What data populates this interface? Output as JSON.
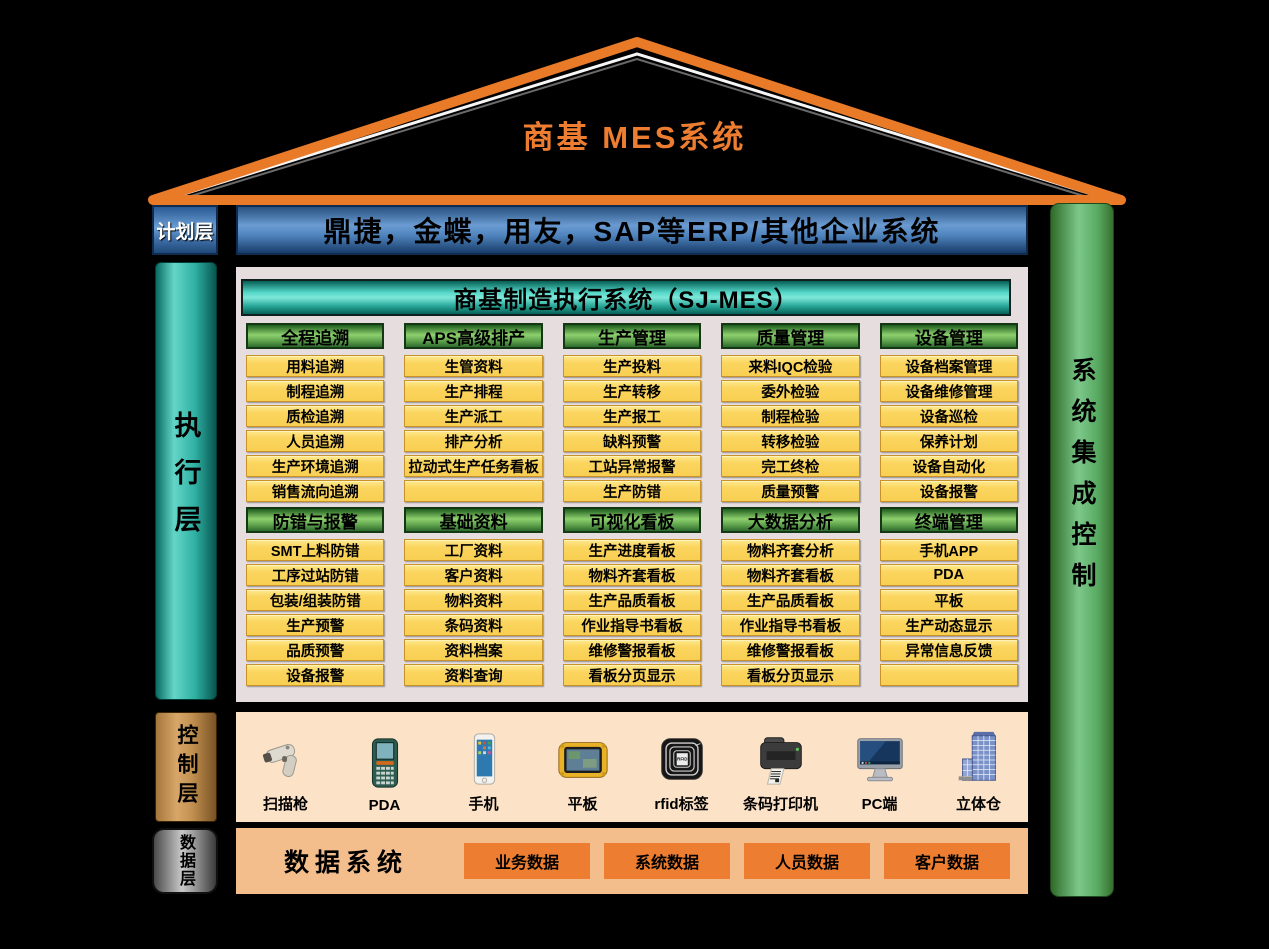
{
  "roof": {
    "title": "商基  MES系统"
  },
  "planning": {
    "label": "计划层",
    "banner": "鼎捷，金蝶，用友，SAP等ERP/其他企业系统"
  },
  "execution": {
    "label": "执行层",
    "header": "商基制造执行系统（SJ-MES）",
    "rows": [
      [
        {
          "title": "全程追溯",
          "items": [
            "用料追溯",
            "制程追溯",
            "质检追溯",
            "人员追溯",
            "生产环境追溯",
            "销售流向追溯"
          ]
        },
        {
          "title": "APS高级排产",
          "items": [
            "生管资料",
            "生产排程",
            "生产派工",
            "排产分析",
            "拉动式生产任务看板",
            ""
          ]
        },
        {
          "title": "生产管理",
          "items": [
            "生产投料",
            "生产转移",
            "生产报工",
            "缺料预警",
            "工站异常报警",
            "生产防错"
          ]
        },
        {
          "title": "质量管理",
          "items": [
            "来料IQC检验",
            "委外检验",
            "制程检验",
            "转移检验",
            "完工终检",
            "质量预警"
          ]
        },
        {
          "title": "设备管理",
          "items": [
            "设备档案管理",
            "设备维修管理",
            "设备巡检",
            "保养计划",
            "设备自动化",
            "设备报警"
          ]
        }
      ],
      [
        {
          "title": "防错与报警",
          "items": [
            "SMT上料防错",
            "工序过站防错",
            "包装/组装防错",
            "生产预警",
            "品质预警",
            "设备报警"
          ]
        },
        {
          "title": "基础资料",
          "items": [
            "工厂资料",
            "客户资料",
            "物料资料",
            "条码资料",
            "资料档案",
            "资料查询"
          ]
        },
        {
          "title": "可视化看板",
          "items": [
            "生产进度看板",
            "物料齐套看板",
            "生产品质看板",
            "作业指导书看板",
            "维修警报看板",
            "看板分页显示"
          ]
        },
        {
          "title": "大数据分析",
          "items": [
            "物料齐套分析",
            "物料齐套看板",
            "生产品质看板",
            "作业指导书看板",
            "维修警报看板",
            "看板分页显示"
          ]
        },
        {
          "title": "终端管理",
          "items": [
            "手机APP",
            "PDA",
            "平板",
            "生产动态显示",
            "异常信息反馈",
            ""
          ]
        }
      ]
    ]
  },
  "control": {
    "label": "控制层",
    "devices": [
      {
        "icon": "scanner-gun-icon",
        "label": "扫描枪"
      },
      {
        "icon": "pda-icon",
        "label": "PDA"
      },
      {
        "icon": "smartphone-icon",
        "label": "手机"
      },
      {
        "icon": "tablet-icon",
        "label": "平板"
      },
      {
        "icon": "rfid-tag-icon",
        "label": "rfid标签"
      },
      {
        "icon": "barcode-printer-icon",
        "label": "条码打印机"
      },
      {
        "icon": "pc-icon",
        "label": "PC端"
      },
      {
        "icon": "warehouse-icon",
        "label": "立体仓"
      }
    ]
  },
  "data_layer": {
    "label": "数据层",
    "title": "数据系统",
    "boxes": [
      "业务数据",
      "系统数据",
      "人员数据",
      "客户数据"
    ]
  },
  "integration": {
    "label": "系统集成控制"
  },
  "colors": {
    "roof_orange": "#ED7D31",
    "banner_blue": "#5B8FC9",
    "teal": "#2FB0A3",
    "header_green": "#5A9E4A",
    "item_yellow": "#FBD55F",
    "control_peach": "#FCE2C6",
    "data_orange_panel": "#F3BD8C",
    "data_orange_box": "#ED7D31",
    "integration_green": "#6FC583"
  }
}
